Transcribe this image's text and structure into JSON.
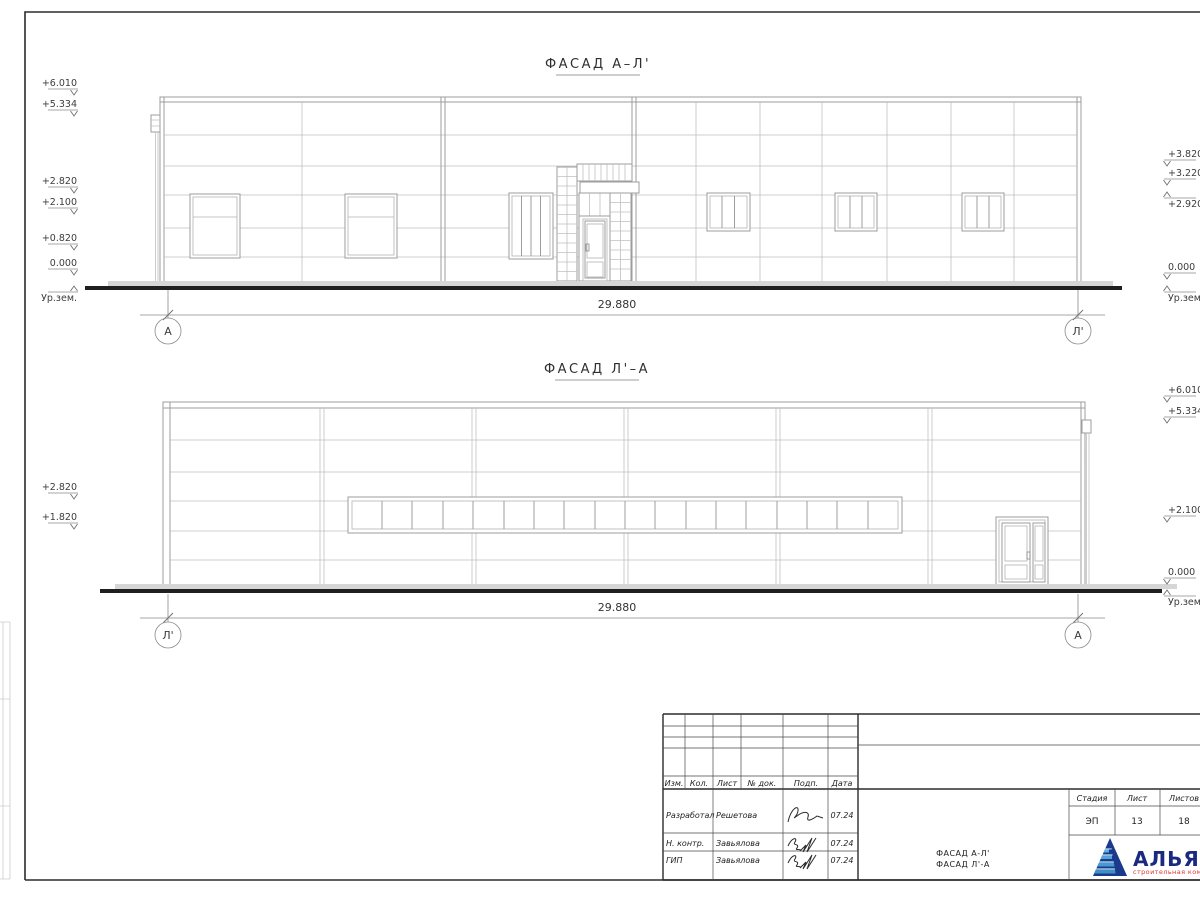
{
  "facade_top": {
    "title": "ФАСАД А–Л'",
    "dim": "29.880",
    "axis_left": "А",
    "axis_right": "Л'",
    "marks_left": [
      "+6.010",
      "+5.334",
      "+2.820",
      "+2.100",
      "+0.820",
      "0.000",
      "Ур.зем."
    ],
    "marks_right": [
      "+3.820",
      "+3.220",
      "+2.920",
      "0.000",
      "Ур.зем."
    ]
  },
  "facade_bottom": {
    "title": "ФАСАД Л'–А",
    "dim": "29.880",
    "axis_left": "Л'",
    "axis_right": "А",
    "marks_left": [
      "+2.820",
      "+1.820"
    ],
    "marks_right": [
      "+6.010",
      "+5.334",
      "+2.100",
      "0.000",
      "Ур.зем."
    ]
  },
  "titleblock": {
    "header": [
      "Изм.",
      "Кол.",
      "Лист",
      "№ док.",
      "Подп.",
      "Дата"
    ],
    "rows": [
      {
        "role": "Разработал",
        "name": "Решетова",
        "date": "07.24"
      },
      {
        "role": "Н. контр.",
        "name": "Завьялова",
        "date": "07.24"
      },
      {
        "role": "ГИП",
        "name": "Завьялова",
        "date": "07.24"
      }
    ],
    "stage_label": "Стадия",
    "sheet_label": "Лист",
    "sheets_label": "Листов",
    "stage": "ЭП",
    "sheet": "13",
    "sheets": "18",
    "title_line1": "ФАСАД А-Л'",
    "title_line2": "ФАСАД Л'-А",
    "logo_text": "АЛЬЯНС",
    "logo_sub": "строительная компания"
  },
  "colors": {
    "logo_blue": "#1b3a8c",
    "logo_light": "#3f8fc9",
    "logo_red": "#d93636"
  }
}
